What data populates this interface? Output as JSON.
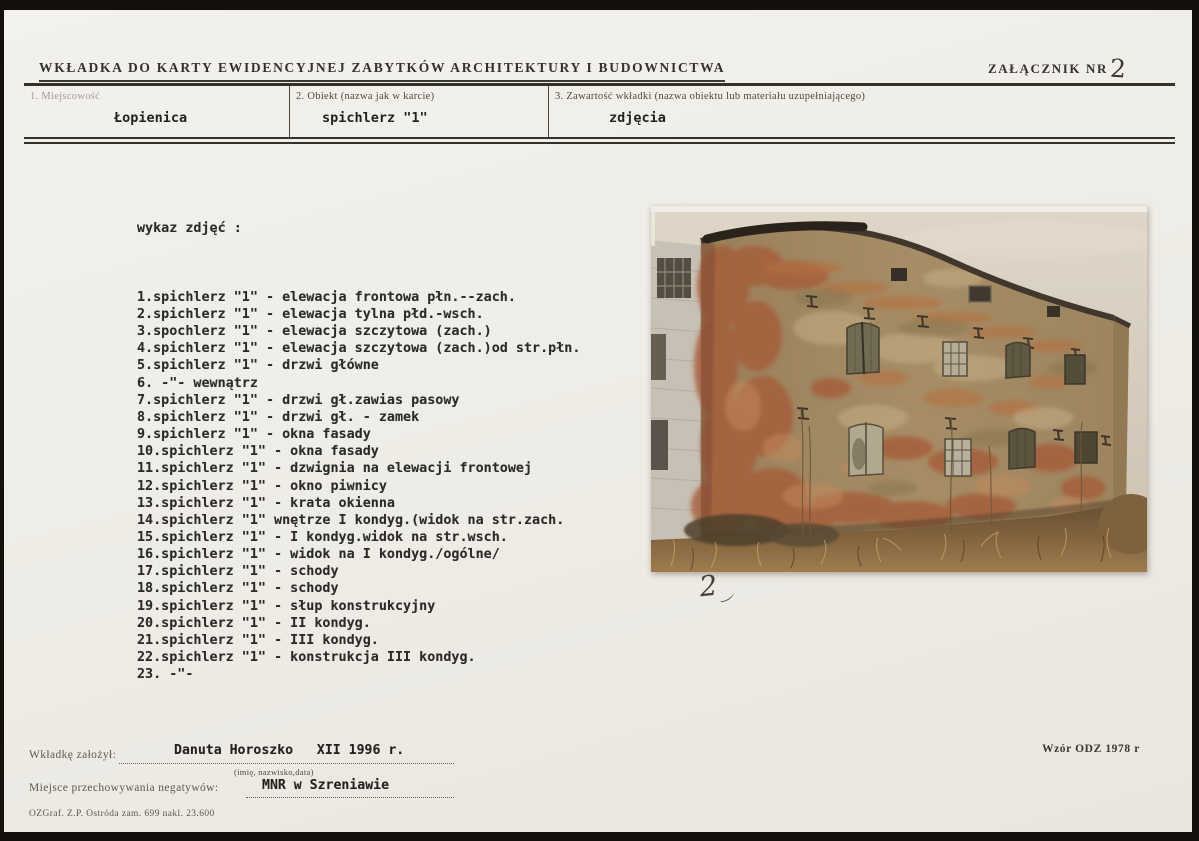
{
  "form": {
    "title": "WKŁADKA DO KARTY EWIDENCYJNEJ ZABYTKÓW ARCHITEKTURY I BUDOWNICTWA",
    "attachment_label": "ZAŁĄCZNIK NR",
    "attachment_number": "2",
    "fields": [
      {
        "label": "1. Miejscowość",
        "value": "Łopienica"
      },
      {
        "label": "2. Obiekt (nazwa jak w karcie)",
        "value": "spichlerz \"1\""
      },
      {
        "label": "3. Zawartość wkładki (nazwa obiektu lub materiału uzupełniającego)",
        "value": "zdjęcia"
      }
    ]
  },
  "photo_list": {
    "heading": "wykaz zdjęć :",
    "items": [
      "1.spichlerz \"1\" - elewacja frontowa płn.--zach.",
      "2.spichlerz \"1\" - elewacja tylna płd.-wsch.",
      "3.spochlerz \"1\" - elewacja szczytowa (zach.)",
      "4.spichlerz \"1\" - elewacja szczytowa (zach.)od str.płn.",
      "5.spichlerz \"1\" - drzwi główne",
      "6. -\"- wewnątrz",
      "7.spichlerz \"1\" - drzwi gł.zawias pasowy",
      "8.spichlerz \"1\" - drzwi gł. - zamek",
      "9.spichlerz \"1\" - okna fasady",
      "10.spichlerz \"1\" - okna fasady",
      "11.spichlerz \"1\" - dzwignia na elewacji frontowej",
      "12.spichlerz \"1\" - okno piwnicy",
      "13.spichlerz \"1\" - krata okienna",
      "14.spichlerz \"1\" wnętrze I kondyg.(widok na str.zach.",
      "15.spichlerz \"1\" - I kondyg.widok na str.wsch.",
      "16.spichlerz \"1\" - widok na I kondyg./ogólne/",
      "17.spichlerz \"1\" - schody",
      "18.spichlerz \"1\" - schody",
      "19.spichlerz \"1\" - słup konstrukcyjny",
      "20.spichlerz \"1\" - II kondyg.",
      "21.spichlerz \"1\" - III kondyg.",
      "22.spichlerz \"1\" - konstrukcja III kondyg.",
      "23. -\"-"
    ]
  },
  "photo": {
    "handwritten_number": "2"
  },
  "footer": {
    "founder_label": "Wkładkę założył:",
    "founder_value": "Danuta Horoszko   XII 1996 r.",
    "founder_caption": "(imię, nazwisko,data)",
    "negatives_label": "Miejsce przechowywania negatywów:",
    "negatives_value": "MNR w Szreniawie",
    "print_info": "OZGraf. Z.P. Ostróda zam. 699 nakl. 23.600",
    "template_info": "Wzór ODZ 1978 r"
  },
  "colors": {
    "paper": "#efede7",
    "ink": "#232220",
    "brick": "#a85b3a",
    "plaster": "#a18a62",
    "sky": "#d8d2c5"
  }
}
